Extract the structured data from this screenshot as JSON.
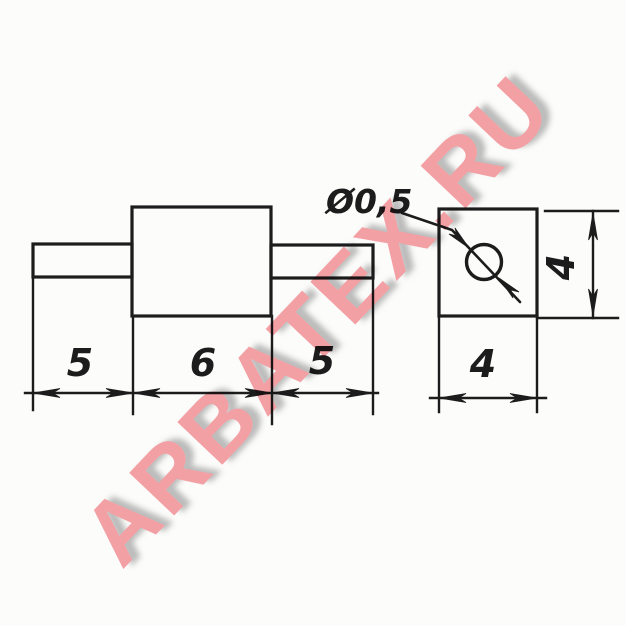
{
  "watermark": {
    "text": "ARBATEX.RU",
    "color": "#f69aa0",
    "shadow_color": "#bdbdbd"
  },
  "drawing": {
    "front_view": {
      "dim_lead_left": "5",
      "dim_body_length": "6",
      "dim_lead_right": "5"
    },
    "end_view": {
      "dim_wire_diameter": "Ø0,5",
      "dim_height": "4",
      "dim_width": "4"
    }
  },
  "colors": {
    "line": "#1c1c1c",
    "paper": "#fcfcfb"
  }
}
